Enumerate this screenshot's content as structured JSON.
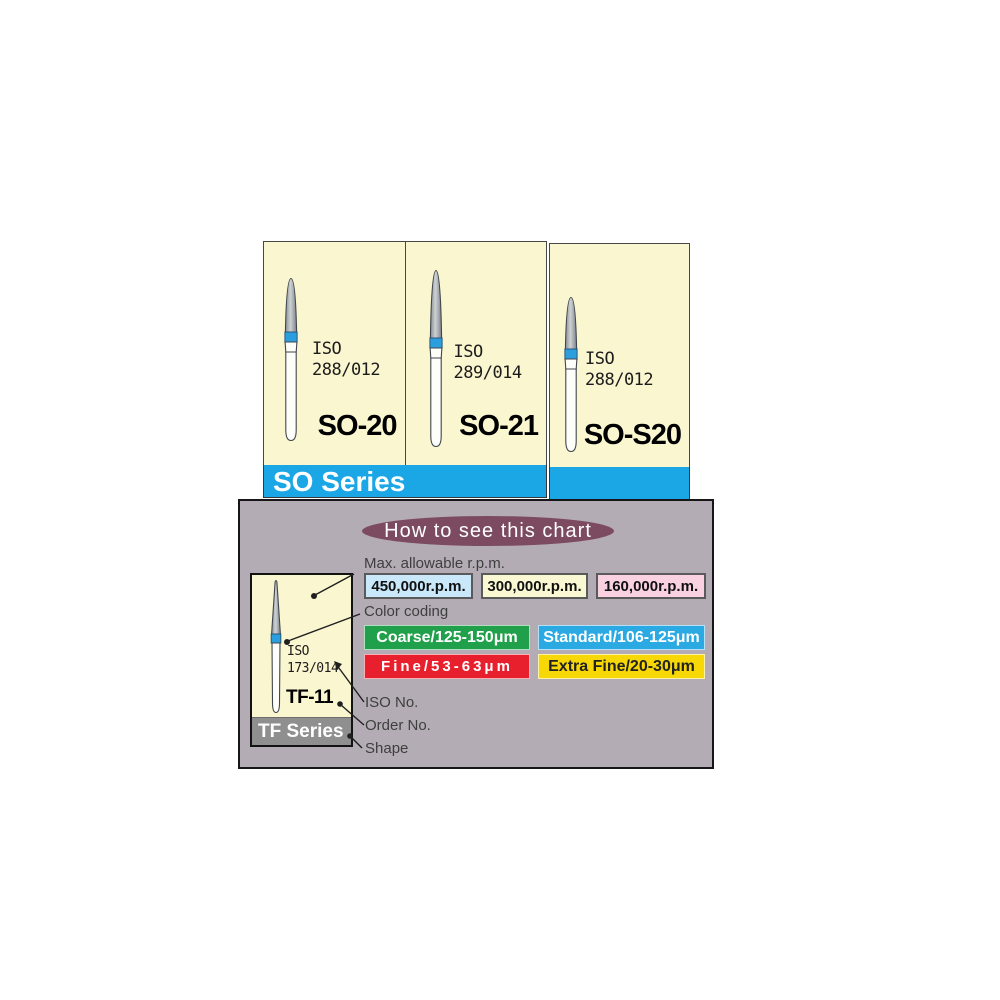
{
  "so_series": {
    "banner_label": "SO Series",
    "products": [
      {
        "name": "SO-20",
        "iso_line1": "ISO",
        "iso_line2": "288/012"
      },
      {
        "name": "SO-21",
        "iso_line1": "ISO",
        "iso_line2": "289/014"
      },
      {
        "name": "SO-S20",
        "iso_line1": "ISO",
        "iso_line2": "288/012"
      }
    ],
    "colors": {
      "banner_blue": "#1BA7E6",
      "card_cream": "#FAF6D0",
      "bur_band_blue": "#2B9FDE"
    }
  },
  "legend": {
    "title": "How to see this chart",
    "rpm_label": "Max. allowable r.p.m.",
    "rpm_options": [
      {
        "text": "450,000r.p.m.",
        "bg": "#C9E9FB"
      },
      {
        "text": "300,000r.p.m.",
        "bg": "#FAF8D3"
      },
      {
        "text": "160,000r.p.m.",
        "bg": "#F9D1E1"
      }
    ],
    "color_coding_label": "Color coding",
    "color_options": [
      {
        "text": "Coarse/125-150μm",
        "bg": "#21A04B",
        "fg": "#ffffff"
      },
      {
        "text": "Standard/106-125μm",
        "bg": "#2AA9E3",
        "fg": "#ffffff"
      },
      {
        "text": "Fine/53-63μm",
        "bg": "#E8202D",
        "fg": "#ffffff"
      },
      {
        "text": "Extra Fine/20-30μm",
        "bg": "#F7D806",
        "fg": "#222222"
      }
    ],
    "callouts": {
      "iso_no": "ISO No.",
      "order_no": "Order No.",
      "shape": "Shape"
    },
    "example": {
      "name": "TF-11",
      "iso_line1": "ISO",
      "iso_line2": "173/014",
      "series_label": "TF Series"
    },
    "colors": {
      "panel_gray": "#B4ACB5",
      "title_oval": "#7C4B61",
      "series_band_gray": "#8F8F8F"
    }
  }
}
